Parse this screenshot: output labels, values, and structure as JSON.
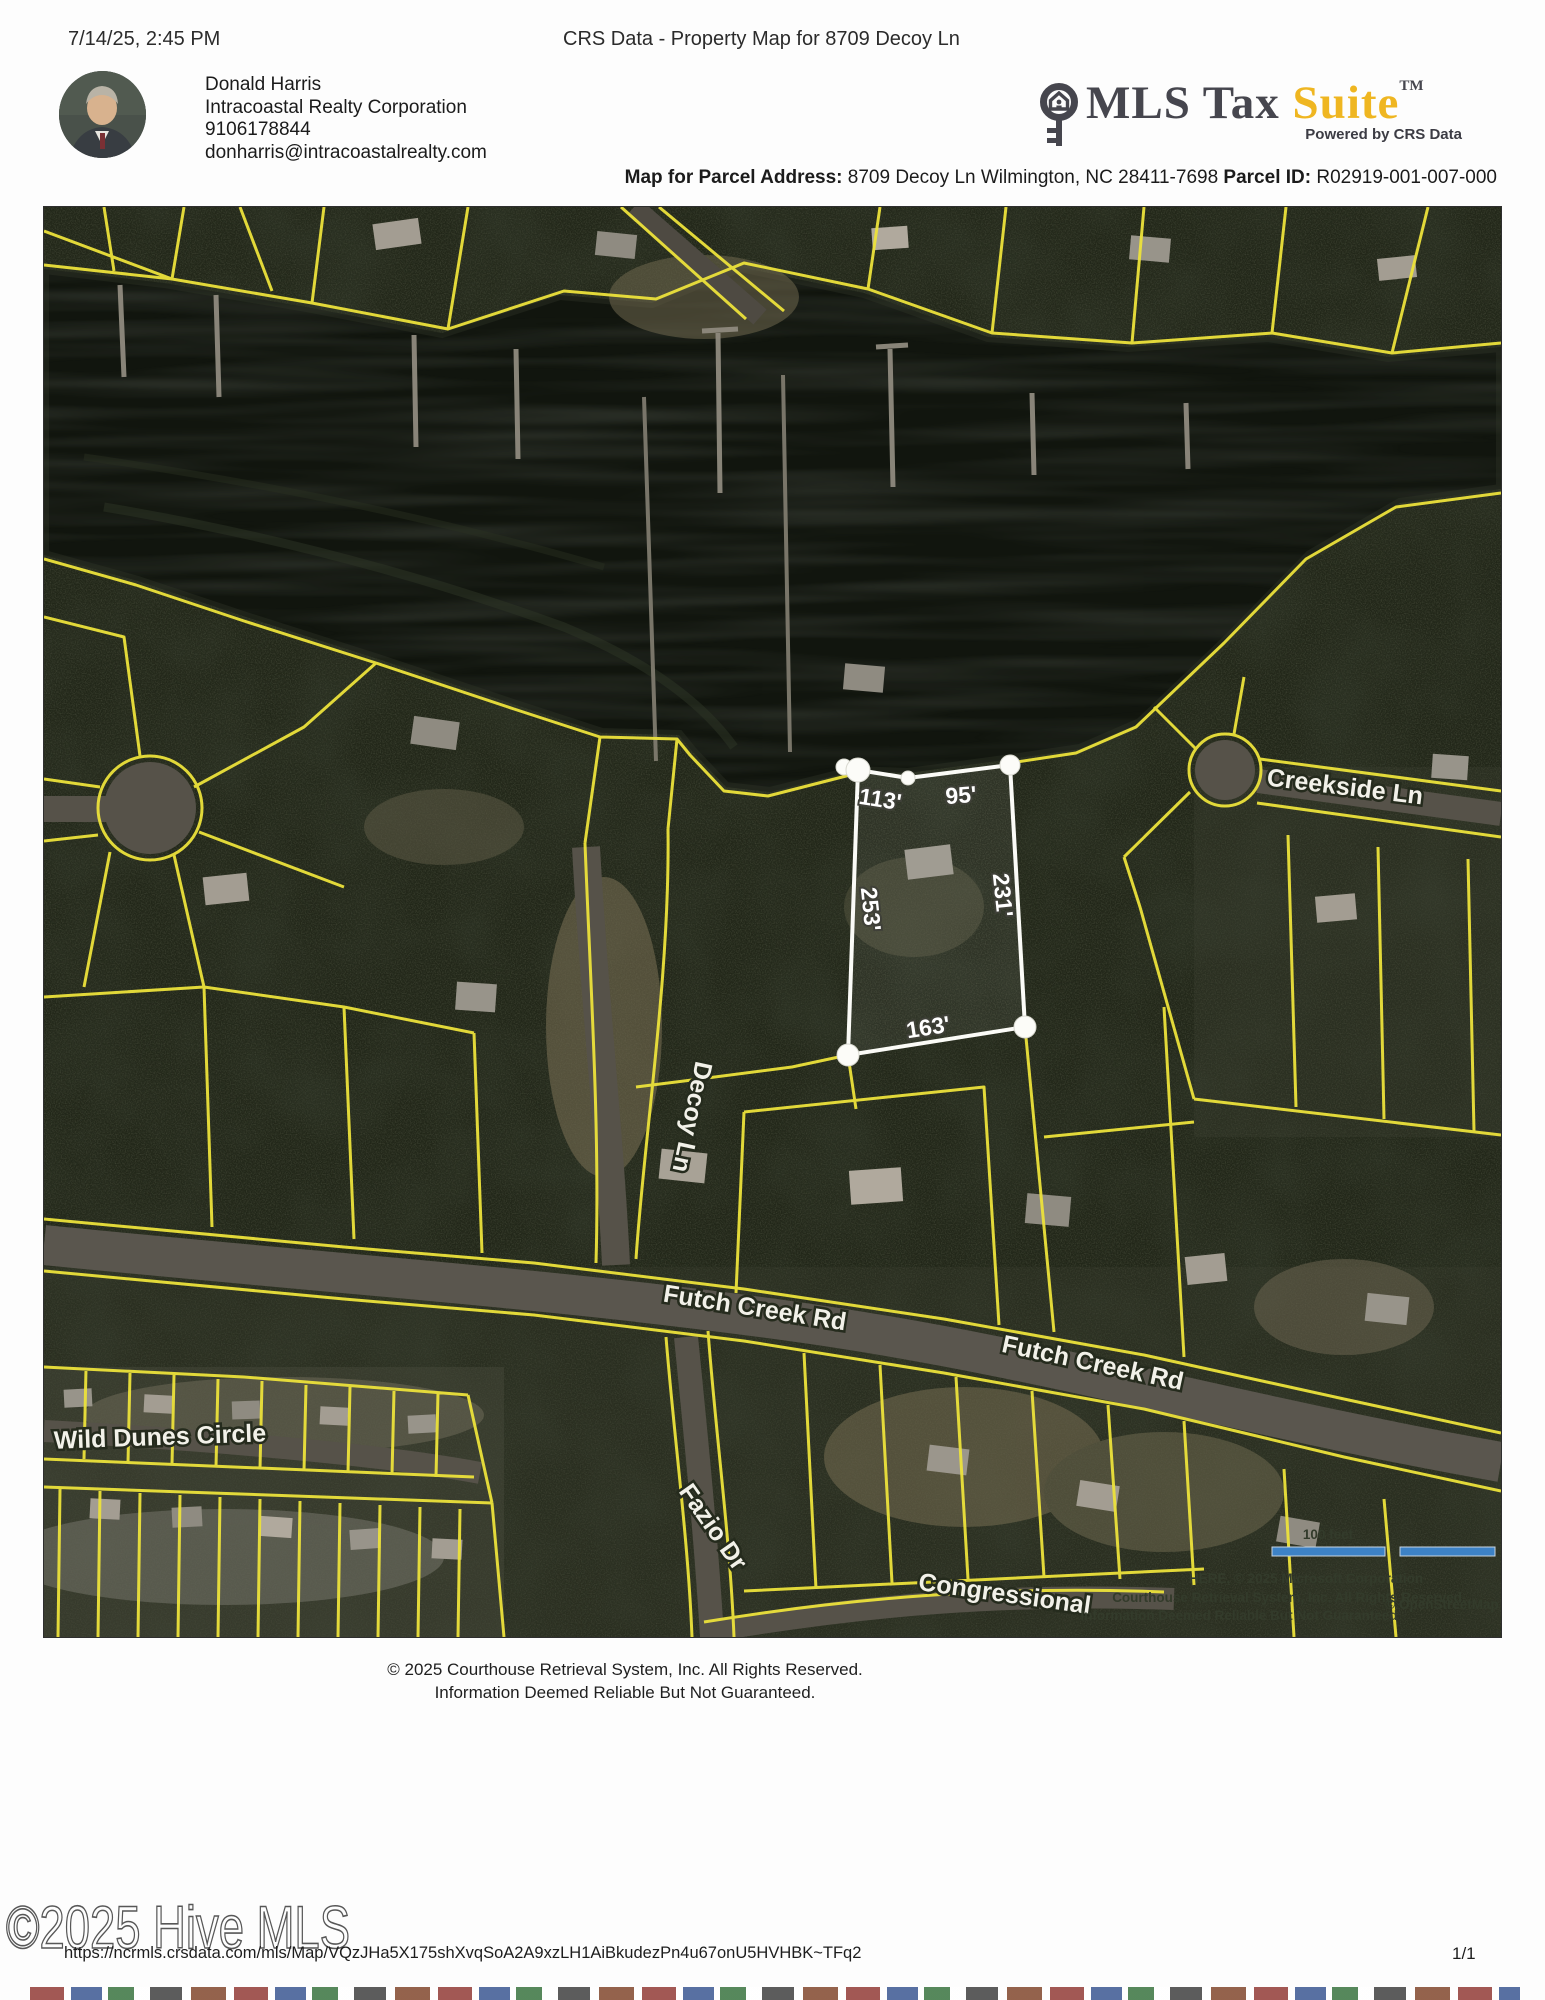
{
  "page": {
    "timestamp": "7/14/25, 2:45 PM",
    "title": "CRS Data - Property Map for 8709 Decoy Ln",
    "page_number": "1/1",
    "url": "https://ncrmls.crsdata.com/mls/Map/VQzJHa5X175shXvqSoA2A9xzLH1AiBkudezPn4u67onU5HVHBK~TFq2",
    "watermark": "©2025 Hive MLS"
  },
  "agent": {
    "name": "Donald Harris",
    "company": "Intracoastal Realty Corporation",
    "phone": "9106178844",
    "email": "donharris@intracoastalrealty.com"
  },
  "logo": {
    "mls_tax": "MLS Tax",
    "suite": "Suite",
    "tm": "TM",
    "tagline": "Powered by CRS Data",
    "suite_color": "#efb621"
  },
  "parcel_header": {
    "address_label": "Map for Parcel Address:",
    "address_value": " 8709 Decoy Ln Wilmington, NC 28411-7698 ",
    "parcel_id_label": "Parcel ID:",
    "parcel_id_value": " R02919-001-007-000"
  },
  "map": {
    "streets": {
      "creekside": "Creekside Ln",
      "decoy": "Decoy Ln",
      "futch_west": "Futch Creek Rd",
      "futch_east": "Futch Creek Rd",
      "wild_dunes": "Wild Dunes Circle",
      "fazio": "Fazio Dr",
      "congressional": "Congressional"
    },
    "subject_parcel": {
      "dim_top_left": "113'",
      "dim_top_right": "95'",
      "dim_left": "253'",
      "dim_right": "231'",
      "dim_bottom": "163'"
    },
    "scale_label": "100 feet",
    "attribution": {
      "line1": "HERE, © 2025 Microsoft Corporation",
      "line2": "Courthouse Retrieval System, Inc. All Rights Reserved.",
      "line3": "Information Deemed Reliable But Not Guaranteed",
      "osm": "© OpenStreetMap"
    },
    "colors": {
      "parcel_line": "#ece23b",
      "subject_outline": "#ffffff",
      "scale_bar": "#3d82c6"
    }
  },
  "footer": {
    "line1": "© 2025 Courthouse Retrieval System, Inc. All Rights Reserved.",
    "line2": "Information Deemed Reliable But Not Guaranteed."
  }
}
